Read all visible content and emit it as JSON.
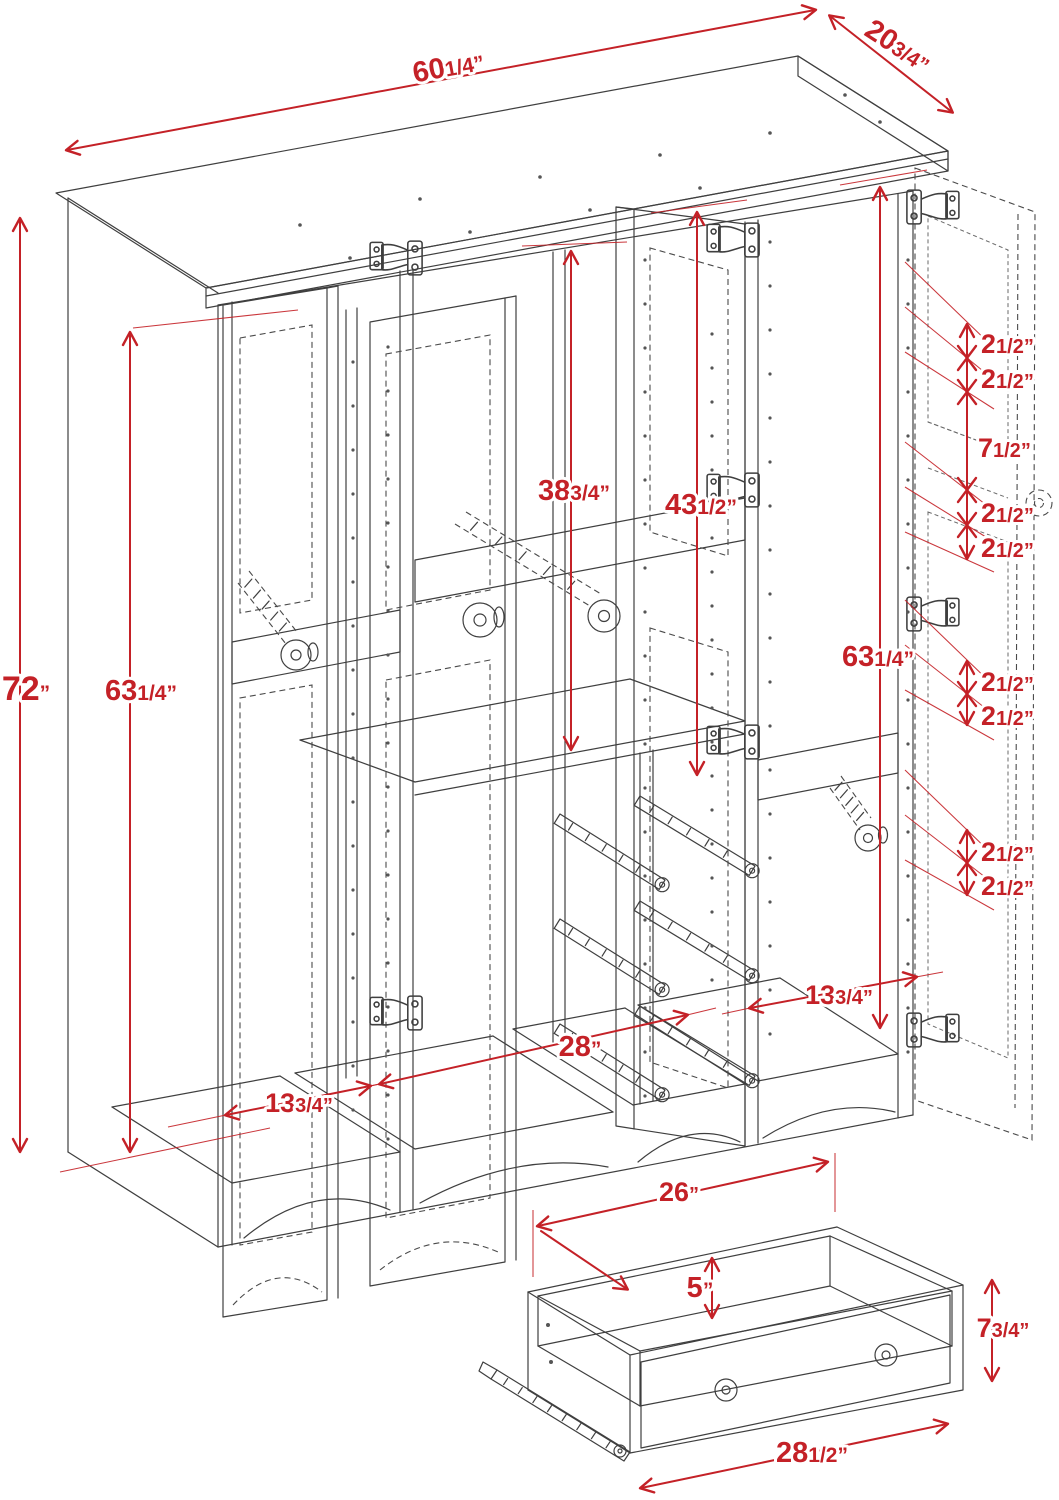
{
  "drawing": {
    "type": "furniture-dimension-diagram",
    "subject": "4-door wardrobe armoire with interior shelf, hanging rods, drawer slides and detached drawer detail",
    "colors": {
      "dimension_red": "#c42127",
      "line_color": "#3f3f3f",
      "background": "#ffffff"
    }
  },
  "dimensions": {
    "top_width": {
      "whole": "60",
      "fraction": "1/4",
      "unit": "”"
    },
    "top_depth": {
      "whole": "20",
      "fraction": "3/4",
      "unit": "”"
    },
    "overall_height": {
      "whole": "72",
      "fraction": "",
      "unit": "”"
    },
    "left_interior_height": {
      "whole": "63",
      "fraction": "1/4",
      "unit": "”"
    },
    "center_top_to_shelf": {
      "whole": "38",
      "fraction": "3/4",
      "unit": "”"
    },
    "center_opening_height": {
      "whole": "43",
      "fraction": "1/2",
      "unit": "”"
    },
    "right_interior_height": {
      "whole": "63",
      "fraction": "1/4",
      "unit": "”"
    },
    "left_section_width": {
      "whole": "13",
      "fraction": "3/4",
      "unit": "”"
    },
    "center_section_width": {
      "whole": "28",
      "fraction": "",
      "unit": "”"
    },
    "right_section_width": {
      "whole": "13",
      "fraction": "3/4",
      "unit": "”"
    },
    "drawer_inner_width": {
      "whole": "26",
      "fraction": "",
      "unit": "”"
    },
    "drawer_inner_height": {
      "whole": "5",
      "fraction": "",
      "unit": "”"
    },
    "drawer_front_height": {
      "whole": "7",
      "fraction": "3/4",
      "unit": "”"
    },
    "drawer_outer_width": {
      "whole": "28",
      "fraction": "1/2",
      "unit": "”"
    }
  },
  "hole_spacing": {
    "upper_group": [
      {
        "whole": "2",
        "fraction": "1/2",
        "unit": "”"
      },
      {
        "whole": "2",
        "fraction": "1/2",
        "unit": "”"
      },
      {
        "whole": "7",
        "fraction": "1/2",
        "unit": "”"
      },
      {
        "whole": "2",
        "fraction": "1/2",
        "unit": "”"
      },
      {
        "whole": "2",
        "fraction": "1/2",
        "unit": "”"
      }
    ],
    "middle_group": [
      {
        "whole": "2",
        "fraction": "1/2",
        "unit": "”"
      },
      {
        "whole": "2",
        "fraction": "1/2",
        "unit": "”"
      }
    ],
    "lower_group": [
      {
        "whole": "2",
        "fraction": "1/2",
        "unit": "”"
      },
      {
        "whole": "2",
        "fraction": "1/2",
        "unit": "”"
      }
    ]
  }
}
